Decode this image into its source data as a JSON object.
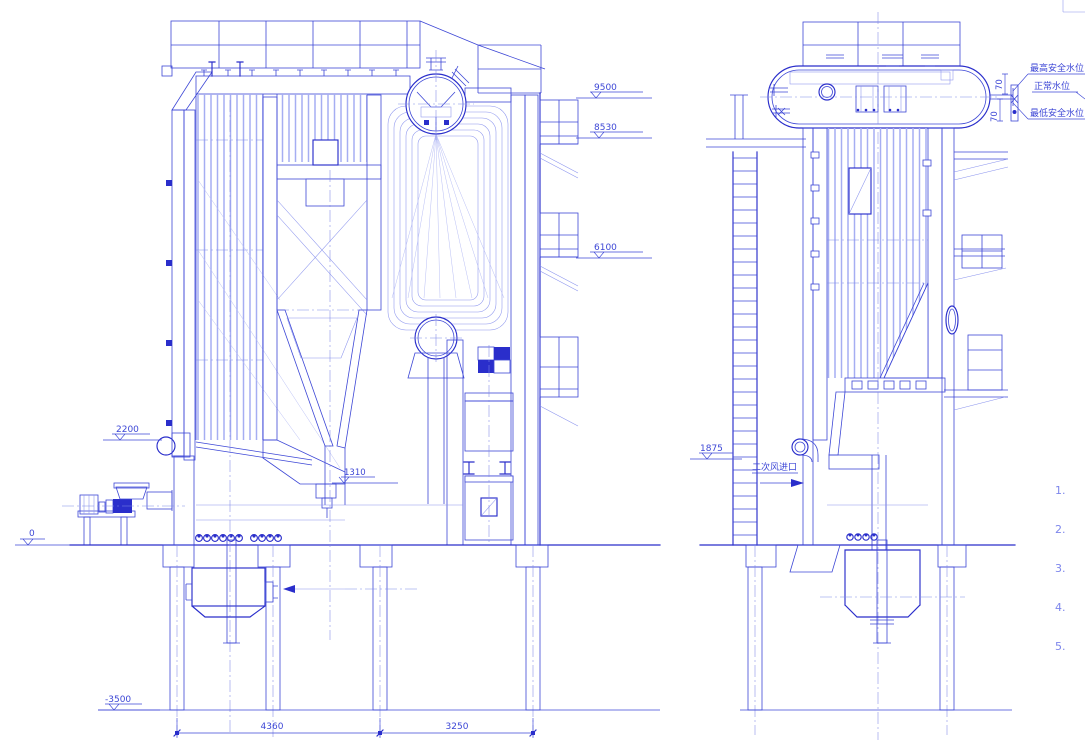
{
  "drawing_type": "boiler general arrangement - two sectional views",
  "left_view": {
    "elevations": {
      "e9500": "9500",
      "e8530": "8530",
      "e6100": "6100",
      "e2200": "2200",
      "e1310": "1310",
      "e0": "0",
      "em3500": "-3500"
    },
    "dimensions": {
      "span_left": "4360",
      "span_right": "3250"
    }
  },
  "right_view": {
    "elevations": {
      "e1875": "1875"
    },
    "water_levels": {
      "high": "最高安全水位",
      "normal": "正常水位",
      "low": "最低安全水位"
    },
    "gauge_dimensions": {
      "upper": "70",
      "lower": "70"
    },
    "labels": {
      "secondary_air_inlet": "二次风进口"
    }
  },
  "notes": {
    "n1": "1.",
    "n2": "2.",
    "n3": "3.",
    "n4": "4.",
    "n5": "5."
  },
  "colors": {
    "line": "#2a2ecb",
    "medium": "#3d47d6",
    "light": "#8a93ee",
    "background": "#ffffff"
  }
}
